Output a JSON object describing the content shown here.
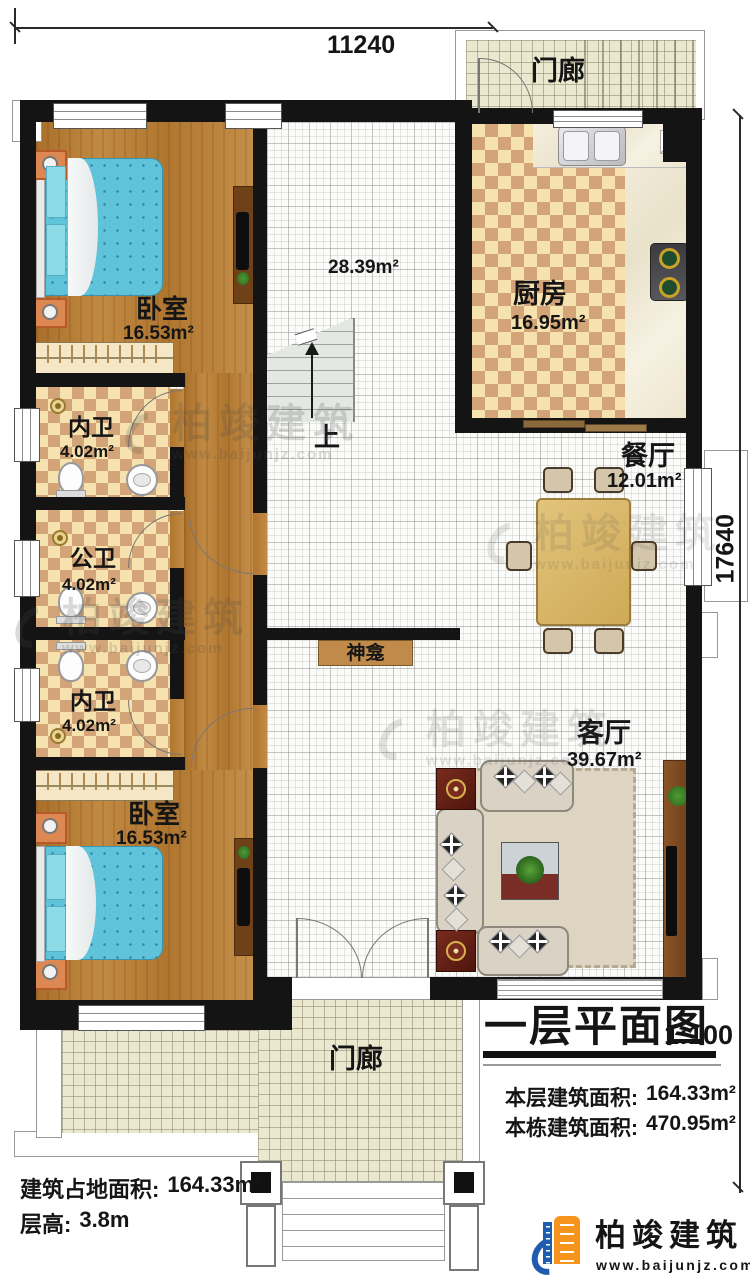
{
  "dimensions": {
    "top": "11240",
    "right_v": "17640"
  },
  "rooms": {
    "porch_top": {
      "name": "门廊"
    },
    "kitchen": {
      "name": "厨房",
      "area": "16.95m²"
    },
    "dining": {
      "name": "餐厅",
      "area": "12.01m²"
    },
    "hall": {
      "area": "28.39m²"
    },
    "bedroom_top": {
      "name": "卧室",
      "area": "16.53m²"
    },
    "bath_inner_top": {
      "name": "内卫",
      "area": "4.02m²"
    },
    "bath_public": {
      "name": "公卫",
      "area": "4.02m²"
    },
    "bath_inner_bottom": {
      "name": "内卫",
      "area": "4.02m²"
    },
    "bedroom_bottom": {
      "name": "卧室",
      "area": "16.53m²"
    },
    "living": {
      "name": "客厅",
      "area": "39.67m²"
    },
    "shrine": {
      "name": "神龛"
    },
    "porch_bottom": {
      "name": "门廊"
    }
  },
  "stairs": {
    "up_label": "上"
  },
  "title_block": {
    "title": "一层平面图",
    "scale": "1:100",
    "rows": [
      {
        "label": "本层建筑面积:",
        "value": "164.33m²"
      },
      {
        "label": "本栋建筑面积:",
        "value": "470.95m²"
      }
    ]
  },
  "site_info": {
    "rows": [
      {
        "label": "建筑占地面积:",
        "value": "164.33m²"
      },
      {
        "label": "层高:",
        "value": "3.8m"
      }
    ]
  },
  "brand": {
    "name": "柏竣建筑",
    "url": "www.baijunjz.com"
  },
  "colors": {
    "wall": "#141414",
    "wood": "#b57c35",
    "checker_light": "#f6e2ae",
    "checker_dark": "#d2a478",
    "brand_blue": "#1f5cb0",
    "brand_orange": "#f7941d"
  }
}
